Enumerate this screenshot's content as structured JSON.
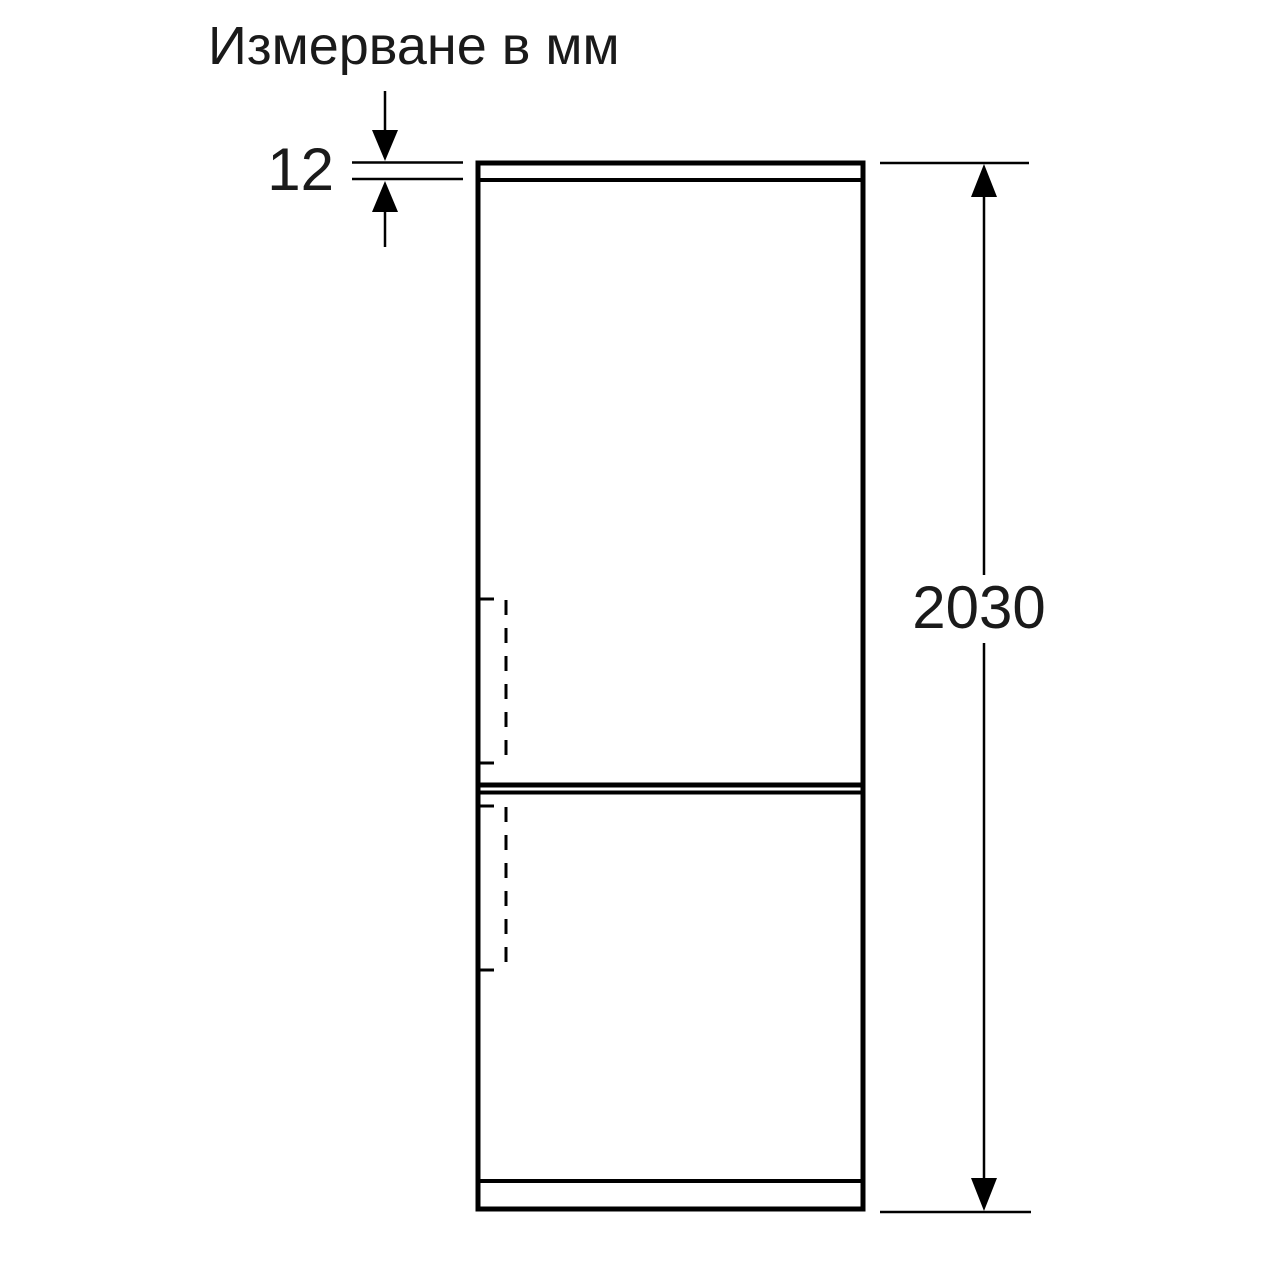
{
  "colors": {
    "background": "#ffffff",
    "line": "#000000",
    "text": "#1a1a1a"
  },
  "diagram": {
    "title": "Измерване в мм",
    "figure": "refrigerator-front-outline",
    "dimensions": {
      "top_panel": {
        "value": "12",
        "unit": "mm"
      },
      "height": {
        "value": "2030",
        "unit": "mm"
      }
    }
  }
}
